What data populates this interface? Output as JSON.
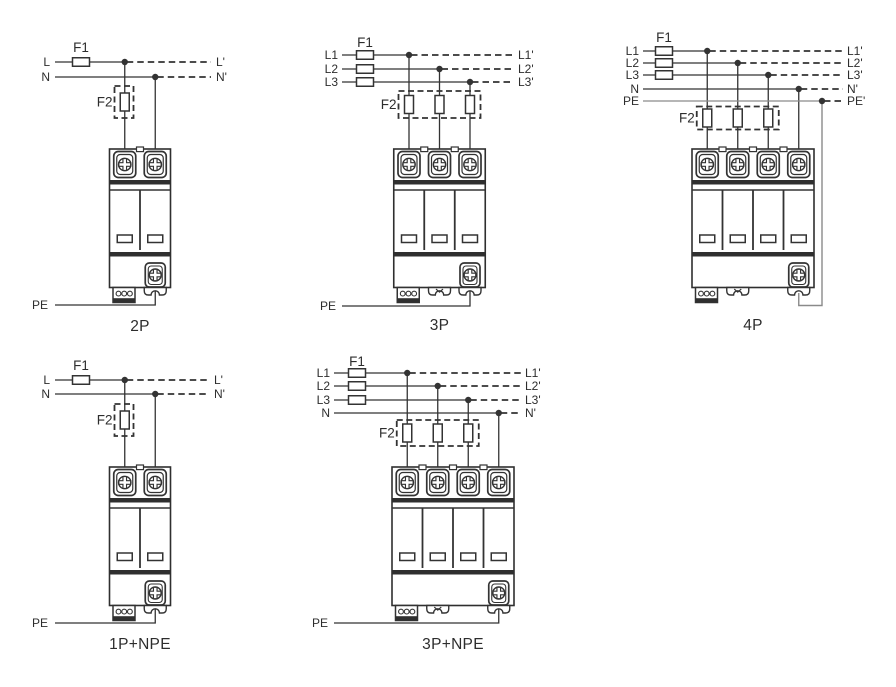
{
  "page": {
    "background": "#ffffff",
    "colors": {
      "wire": "#333333",
      "pe_wire": "#8a8a8a",
      "device_outline": "#2f2f2f",
      "text": "#2d2d2d"
    }
  },
  "diagrams": [
    {
      "caption": "2P",
      "f1": "F1",
      "f2": "F2",
      "pe": "PE",
      "inputs": [
        "L",
        "N"
      ],
      "outputs": [
        "L'",
        "N'"
      ],
      "fused": [
        true,
        false
      ],
      "modules": 2
    },
    {
      "caption": "3P",
      "f1": "F1",
      "f2": "F2",
      "pe": "PE",
      "inputs": [
        "L1",
        "L2",
        "L3"
      ],
      "outputs": [
        "L1'",
        "L2'",
        "L3'"
      ],
      "fused": [
        true,
        true,
        true
      ],
      "modules": 3
    },
    {
      "caption": "4P",
      "f1": "F1",
      "f2": "F2",
      "pe": "",
      "inputs": [
        "L1",
        "L2",
        "L3",
        "N",
        "PE"
      ],
      "outputs": [
        "L1'",
        "L2'",
        "L3'",
        "N'",
        "PE'"
      ],
      "fused": [
        true,
        true,
        true,
        false,
        false
      ],
      "modules": 4
    },
    {
      "caption": "1P+NPE",
      "f1": "F1",
      "f2": "F2",
      "pe": "PE",
      "inputs": [
        "L",
        "N"
      ],
      "outputs": [
        "L'",
        "N'"
      ],
      "fused": [
        true,
        false
      ],
      "modules": 2
    },
    {
      "caption": "3P+NPE",
      "f1": "F1",
      "f2": "F2",
      "pe": "PE",
      "inputs": [
        "L1",
        "L2",
        "L3",
        "N"
      ],
      "outputs": [
        "L1'",
        "L2'",
        "L3'",
        "N'"
      ],
      "fused": [
        true,
        true,
        true,
        false
      ],
      "modules": 4
    }
  ]
}
